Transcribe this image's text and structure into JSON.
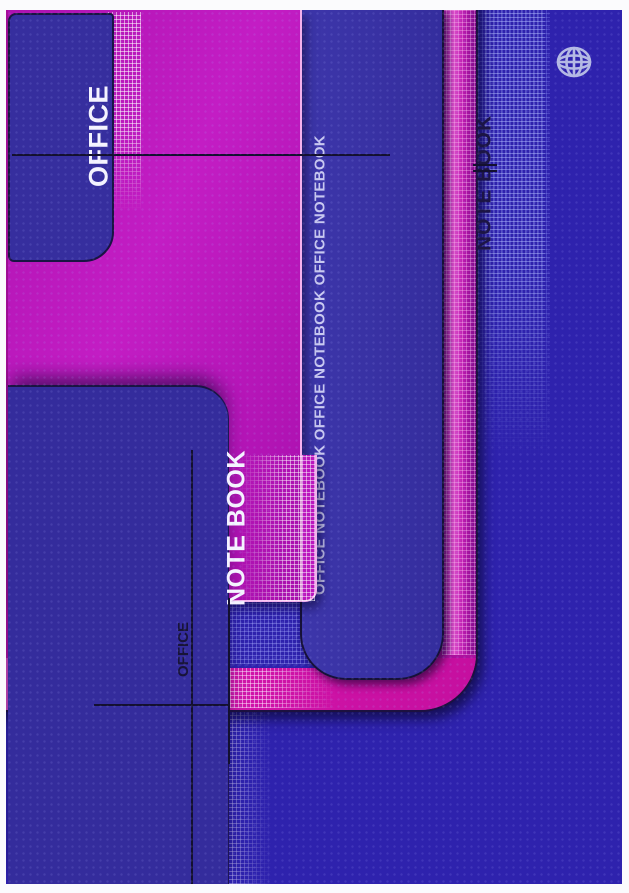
{
  "cover": {
    "texts": {
      "office_vertical_large": "OFFICE",
      "notebook_strip": "OFFICE NOTEBOOK OFFICE NOTEBOOK OFFICE NOTEBOOK",
      "note_book_large": "NOTE BOOK",
      "office_vertical_small": "OFFICE",
      "note_book_side": "NOTE BOOK"
    },
    "icons": {
      "globe": "globe-icon"
    },
    "colors": {
      "background_blue": "#2e22ad",
      "panel_blue": "#3a33a6",
      "box_blue": "#362e9e",
      "plate_magenta": "#b916bb",
      "frame_pink_bright": "#e050ce",
      "frame_pink_deep": "#8c0d96",
      "band_hot_pink": "#d013a8",
      "grid_white": "#ffffff",
      "line_dark": "#131030",
      "text_light": "#f4f3ff",
      "text_mid": "#c9c9f1",
      "text_dark": "#1c1545",
      "globe_icon": "#b4b9e4"
    }
  }
}
